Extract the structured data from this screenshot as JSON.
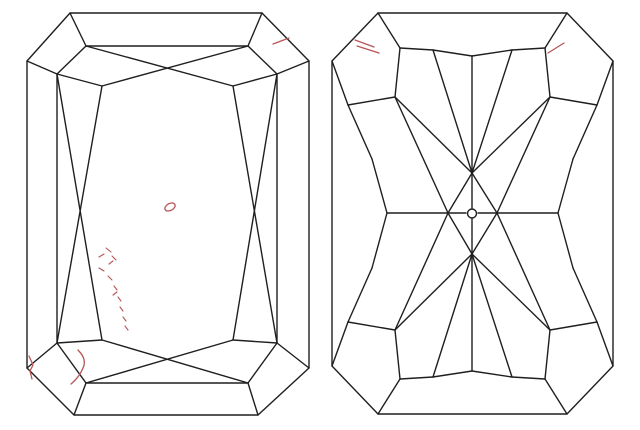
{
  "page": {
    "background": "#ffffff",
    "width": 640,
    "height": 430
  },
  "diagram": {
    "type": "diamond-clarity-plot",
    "cut_shape": "radiant",
    "line_color": "#1f1f1f",
    "line_width": 1.4,
    "inclusion_color": "#b85456",
    "inclusion_line_width": 1.3,
    "views": [
      {
        "name": "crown-view",
        "polygons": [
          {
            "label": "girdle-outline",
            "points": [
              [
                70,
                13
              ],
              [
                262,
                13
              ],
              [
                309,
                61
              ],
              [
                309,
                368
              ],
              [
                258,
                415
              ],
              [
                74,
                415
              ],
              [
                27,
                368
              ],
              [
                27,
                61
              ]
            ]
          },
          {
            "label": "table-outline",
            "points": [
              [
                86,
                46
              ],
              [
                248,
                46
              ],
              [
                277,
                74
              ],
              [
                277,
                343
              ],
              [
                248,
                383
              ],
              [
                86,
                383
              ],
              [
                57,
                343
              ],
              [
                57,
                74
              ]
            ]
          }
        ],
        "segments": [
          [
            70,
            13,
            86,
            46
          ],
          [
            262,
            13,
            248,
            46
          ],
          [
            309,
            61,
            277,
            74
          ],
          [
            309,
            368,
            277,
            343
          ],
          [
            258,
            415,
            248,
            383
          ],
          [
            74,
            415,
            86,
            383
          ],
          [
            27,
            368,
            57,
            343
          ],
          [
            27,
            61,
            57,
            74
          ],
          [
            86,
            46,
            233,
            86
          ],
          [
            248,
            46,
            102,
            86
          ],
          [
            57,
            74,
            102,
            86
          ],
          [
            233,
            86,
            277,
            74
          ],
          [
            86,
            383,
            233,
            340
          ],
          [
            248,
            383,
            102,
            340
          ],
          [
            57,
            343,
            102,
            340
          ],
          [
            233,
            340,
            277,
            343
          ],
          [
            102,
            86,
            57,
            343
          ],
          [
            57,
            74,
            102,
            340
          ],
          [
            233,
            86,
            277,
            343
          ],
          [
            277,
            74,
            233,
            340
          ]
        ],
        "circles": [],
        "inclusions": [
          {
            "type": "line",
            "label": "needle",
            "x1": 273,
            "y1": 44,
            "x2": 289,
            "y2": 38
          },
          {
            "type": "ellipse",
            "label": "crystal",
            "cx": 170,
            "cy": 207,
            "rx": 5.5,
            "ry": 3.5,
            "rot": -28
          },
          {
            "type": "dashes",
            "label": "cloud-trail",
            "segments": [
              [
                106,
                248,
                111,
                252
              ],
              [
                99,
                257,
                104,
                254
              ],
              [
                112,
                256,
                116,
                260
              ],
              [
                99,
                268,
                104,
                271
              ],
              [
                109,
                264,
                113,
                261
              ],
              [
                108,
                276,
                112,
                280
              ],
              [
                114,
                286,
                117,
                290
              ],
              [
                113,
                295,
                117,
                292
              ],
              [
                118,
                297,
                121,
                301
              ],
              [
                120,
                307,
                123,
                311
              ],
              [
                123,
                317,
                126,
                321
              ],
              [
                125,
                326,
                128,
                330
              ]
            ]
          },
          {
            "type": "path",
            "label": "feather",
            "d": "M 78 350 C 84 356 86 362 83 368 C 81 373 77 379 71 384"
          },
          {
            "type": "polyline",
            "label": "corner-feather",
            "points": [
              [
                29,
                356
              ],
              [
                33,
                365
              ],
              [
                30,
                371
              ],
              [
                32,
                379
              ]
            ]
          }
        ]
      },
      {
        "name": "pavilion-view",
        "polygons": [
          {
            "label": "girdle-outline",
            "points": [
              [
                378,
                13
              ],
              [
                567,
                13
              ],
              [
                613,
                61
              ],
              [
                613,
                366
              ],
              [
                567,
                414
              ],
              [
                378,
                414
              ],
              [
                332,
                366
              ],
              [
                332,
                61
              ]
            ]
          }
        ],
        "segments": [
          [
            378,
            13,
            400,
            48
          ],
          [
            400,
            48,
            395,
            97
          ],
          [
            395,
            97,
            348,
            105
          ],
          [
            348,
            105,
            332,
            61
          ],
          [
            567,
            13,
            545,
            48
          ],
          [
            545,
            48,
            550,
            97
          ],
          [
            550,
            97,
            597,
            105
          ],
          [
            597,
            105,
            613,
            61
          ],
          [
            378,
            414,
            400,
            379
          ],
          [
            400,
            379,
            395,
            330
          ],
          [
            395,
            330,
            348,
            322
          ],
          [
            348,
            322,
            332,
            366
          ],
          [
            567,
            414,
            545,
            379
          ],
          [
            545,
            379,
            550,
            330
          ],
          [
            550,
            330,
            597,
            322
          ],
          [
            597,
            322,
            613,
            366
          ],
          [
            400,
            48,
            433,
            50
          ],
          [
            433,
            50,
            472,
            56
          ],
          [
            472,
            56,
            512,
            50
          ],
          [
            512,
            50,
            545,
            48
          ],
          [
            400,
            379,
            433,
            377
          ],
          [
            433,
            377,
            472,
            371
          ],
          [
            472,
            371,
            512,
            377
          ],
          [
            512,
            377,
            545,
            379
          ],
          [
            472,
            56,
            472,
            208
          ],
          [
            472,
            219,
            472,
            371
          ],
          [
            387,
            213,
            466,
            213
          ],
          [
            478,
            213,
            558,
            213
          ],
          [
            433,
            50,
            472,
            173
          ],
          [
            512,
            50,
            472,
            173
          ],
          [
            395,
            97,
            472,
            173
          ],
          [
            550,
            97,
            472,
            173
          ],
          [
            472,
            173,
            448,
            213
          ],
          [
            472,
            173,
            497,
            213
          ],
          [
            433,
            377,
            472,
            254
          ],
          [
            512,
            377,
            472,
            254
          ],
          [
            395,
            330,
            472,
            254
          ],
          [
            550,
            330,
            472,
            254
          ],
          [
            472,
            254,
            448,
            213
          ],
          [
            472,
            254,
            497,
            213
          ],
          [
            395,
            97,
            448,
            213
          ],
          [
            395,
            330,
            448,
            213
          ],
          [
            550,
            97,
            497,
            213
          ],
          [
            550,
            330,
            497,
            213
          ],
          [
            348,
            105,
            372,
            159
          ],
          [
            372,
            159,
            387,
            213
          ],
          [
            387,
            213,
            372,
            268
          ],
          [
            372,
            268,
            348,
            322
          ],
          [
            597,
            105,
            573,
            159
          ],
          [
            573,
            159,
            558,
            213
          ],
          [
            558,
            213,
            573,
            268
          ],
          [
            573,
            268,
            597,
            322
          ]
        ],
        "circles": [
          {
            "label": "culet",
            "cx": 472,
            "cy": 213.5,
            "r": 4.5
          }
        ],
        "inclusions": [
          {
            "type": "line",
            "label": "tick-upper-left-1",
            "x1": 355,
            "y1": 40,
            "x2": 374,
            "y2": 47
          },
          {
            "type": "line",
            "label": "tick-upper-left-2",
            "x1": 357,
            "y1": 46,
            "x2": 379,
            "y2": 53
          },
          {
            "type": "line",
            "label": "tick-upper-right",
            "x1": 548,
            "y1": 53,
            "x2": 564,
            "y2": 43
          }
        ]
      }
    ]
  }
}
